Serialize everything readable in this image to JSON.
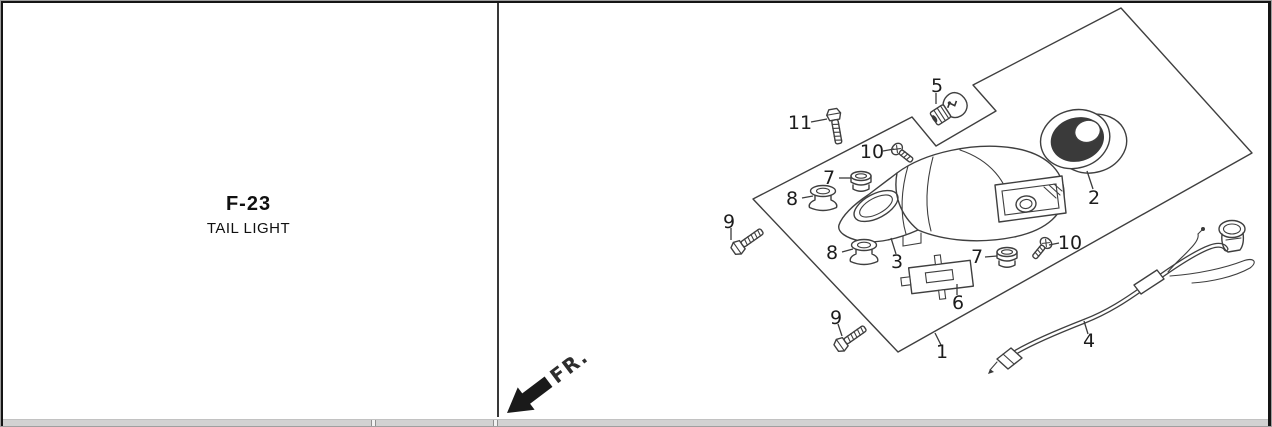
{
  "left_panel": {
    "code": "F-23",
    "title": "TAIL LIGHT"
  },
  "diagram": {
    "fr_label": "FR.",
    "part_labels": [
      {
        "n": "5",
        "x": 937,
        "y": 86
      },
      {
        "n": "11",
        "x": 800,
        "y": 123
      },
      {
        "n": "10",
        "x": 872,
        "y": 152
      },
      {
        "n": "7",
        "x": 829,
        "y": 178
      },
      {
        "n": "8",
        "x": 792,
        "y": 199
      },
      {
        "n": "2",
        "x": 1094,
        "y": 198
      },
      {
        "n": "9",
        "x": 729,
        "y": 222
      },
      {
        "n": "8",
        "x": 832,
        "y": 253
      },
      {
        "n": "3",
        "x": 897,
        "y": 262
      },
      {
        "n": "7",
        "x": 977,
        "y": 257
      },
      {
        "n": "10",
        "x": 1070,
        "y": 243
      },
      {
        "n": "6",
        "x": 958,
        "y": 303
      },
      {
        "n": "9",
        "x": 836,
        "y": 318
      },
      {
        "n": "1",
        "x": 942,
        "y": 352
      },
      {
        "n": "4",
        "x": 1089,
        "y": 341
      }
    ],
    "part_names": {
      "1": "lens panel",
      "2": "lens gasket ring",
      "3": "tail light base",
      "4": "wire harness",
      "5": "bulb",
      "6": "license bracket plate",
      "7": "grommet",
      "8": "grommet",
      "9": "hex bolt",
      "10": "screw",
      "11": "hex bolt"
    }
  },
  "colors": {
    "line": "#3f3f3f",
    "text": "#1c1c1c",
    "band": "#d2d2d2",
    "frame": "#151515"
  }
}
